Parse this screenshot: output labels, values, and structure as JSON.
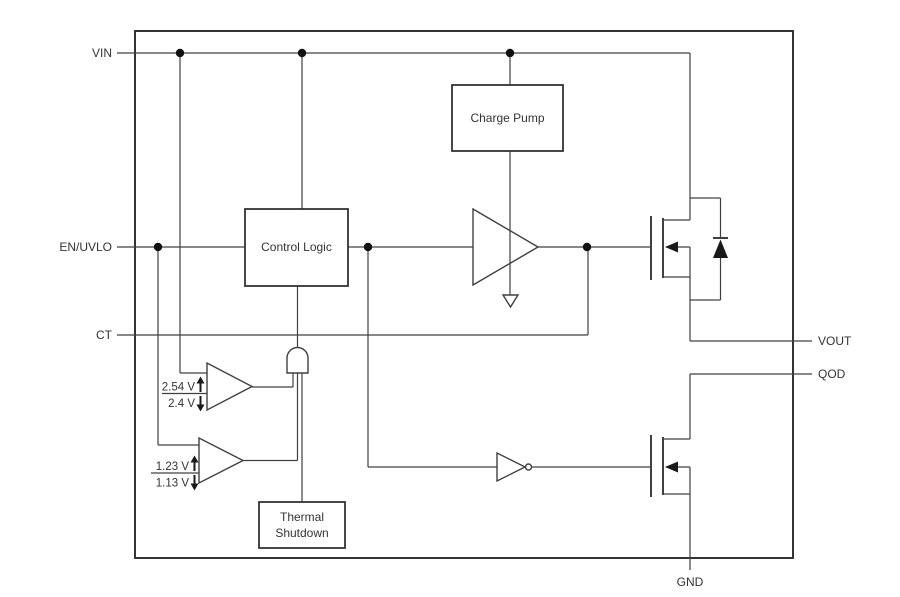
{
  "colors": {
    "background": "#ffffff",
    "line": "#404040",
    "text": "#333333"
  },
  "pins": {
    "vin": "VIN",
    "en_uvlo": "EN/UVLO",
    "ct": "CT",
    "vout": "VOUT",
    "qod": "QOD",
    "gnd": "GND"
  },
  "blocks": {
    "charge_pump": "Charge Pump",
    "control_logic": "Control Logic",
    "thermal_shutdown": {
      "line1": "Thermal",
      "line2": "Shutdown"
    }
  },
  "comparators": {
    "vin_uvlo": {
      "rising_threshold": "2.54 V",
      "falling_threshold": "2.4 V"
    },
    "en_uvlo": {
      "rising_threshold": "1.23 V",
      "falling_threshold": "1.13 V"
    }
  }
}
